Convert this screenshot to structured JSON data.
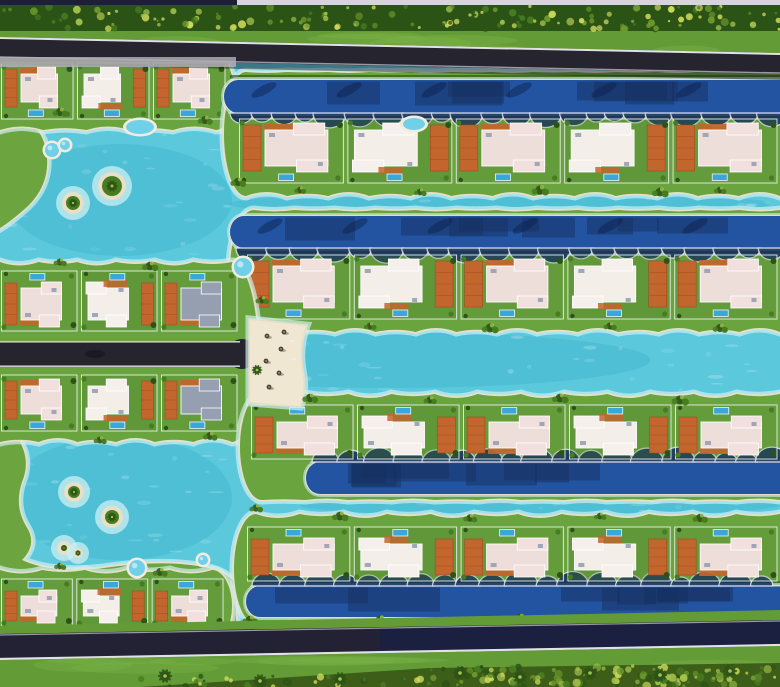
{
  "meta": {
    "description": "Aerial master-plan rendering of a crystal-lagoon villa resort community",
    "alt_text": "Top-down architectural rendering: staggered rows of white flat-roof villas with terracotta decks and private pools on green fingers of land, separated by turquoise lagoons and dark-blue canals, bounded by tree-lined roads at top and bottom"
  },
  "palette": {
    "lagoon": "#5bc8dc",
    "lagoonDeep": "#2ea8c6",
    "shallow": "#cdeff2",
    "sand": "#e9dfc6",
    "canal": "#2254a2",
    "canalShadow": "#152f60",
    "canalEdge": "#dfe2ea",
    "lawn": "#67a13e",
    "lawnDark": "#45742a",
    "hedge": "#2f5a1d",
    "road": "#26242f",
    "roadNavy": "#1c2040",
    "curb": "#e2e2e6",
    "curbSoft": "#9b97a5",
    "roofA": "#f1e0de",
    "roofB": "#f6f0ec",
    "roofGray": "#97a0b2",
    "deck": "#c2662e",
    "deckDark": "#9e4d20",
    "pool": "#39a7da",
    "poolLight": "#6fd0e8",
    "treeDark": "#2c5316",
    "treeMid": "#477d21",
    "treeLight": "#a4c24d",
    "speckle": "#cfd95c",
    "grass": "#639c36",
    "grassLight": "#7cb449",
    "topBarDark": "#1e1e36",
    "topBarLight": "#d8d5d8",
    "canopy": "#3c5e18",
    "apron": "#b7b2ba",
    "umbrella": "#4a4238"
  },
  "topBar": {
    "height": 5,
    "segments": [
      {
        "x": 0,
        "w": 237,
        "color": "topBarDark"
      },
      {
        "x": 237,
        "w": 543,
        "color": "topBarLight"
      }
    ]
  },
  "topBands": {
    "treeTop": 5,
    "treeBottom": 31,
    "grassTop": 29,
    "grassBottom": 57,
    "road": {
      "xTopL": 37,
      "xTopR": 53,
      "xBotL": 58,
      "xBotR": 74
    }
  },
  "bottomBands": {
    "verge": [
      [
        0,
        626
      ],
      [
        780,
        610
      ],
      [
        780,
        622
      ],
      [
        0,
        638
      ]
    ],
    "road": {
      "xTopL": 634,
      "xTopR": 620,
      "xBotL": 660,
      "xBotR": 646
    },
    "grass": [
      [
        0,
        660
      ],
      [
        780,
        646
      ],
      [
        780,
        687
      ],
      [
        0,
        687
      ]
    ],
    "canopy": [
      [
        140,
        687
      ],
      [
        430,
        668
      ],
      [
        780,
        663
      ],
      [
        780,
        687
      ]
    ]
  },
  "waterPatches": [
    {
      "cx": 390,
      "cy": 360,
      "rx": 260,
      "ry": 28
    },
    {
      "cx": 120,
      "cy": 200,
      "rx": 112,
      "ry": 56
    },
    {
      "cx": 120,
      "cy": 498,
      "rx": 112,
      "ry": 62
    },
    {
      "cx": 500,
      "cy": 204,
      "rx": 270,
      "ry": 12
    },
    {
      "cx": 540,
      "cy": 505,
      "rx": 240,
      "ry": 11
    }
  ],
  "sparkleRegions": [
    {
      "x": 10,
      "y": 132,
      "w": 220,
      "h": 128
    },
    {
      "x": 250,
      "y": 332,
      "w": 520,
      "h": 58
    },
    {
      "x": 8,
      "y": 442,
      "w": 220,
      "h": 112
    },
    {
      "x": 250,
      "y": 197,
      "w": 520,
      "h": 16
    },
    {
      "x": 320,
      "y": 497,
      "w": 450,
      "h": 18
    }
  ],
  "shores": [
    {
      "name": "upper-left-shore",
      "d": "M0,108 Q40,118 46,150 Q52,182 28,206 Q10,222 0,228 Z"
    },
    {
      "name": "lower-left-shore",
      "d": "M0,432 L16,436 Q32,458 22,482 Q14,506 26,526 Q38,544 22,560 Q52,574 104,568 Q158,560 198,566 Q226,570 236,584 L236,640 L0,640 Z"
    }
  ],
  "lands": [
    {
      "name": "villa-block-a",
      "x0": 0,
      "x1": 234,
      "yt": 56,
      "yb": 130,
      "ampT": 0,
      "ampB": 7,
      "capL": 0,
      "capR": 18,
      "rows": [
        {
          "x": 0,
          "x1": 228,
          "y": 60,
          "h": 62,
          "units": 3,
          "poolSide": "bottom",
          "style": "left"
        }
      ]
    },
    {
      "name": "lagoon-finger-1",
      "x0": 224,
      "x1": 780,
      "yt": 72,
      "yb": 196,
      "ampT": 2,
      "ampB": 8,
      "capL": 22,
      "capR": 0,
      "canal": {
        "x": 224,
        "y": 80,
        "h": 33,
        "cap": 14,
        "scallop": "bottom",
        "palms": true
      },
      "rows": [
        {
          "x": 238,
          "x1": 780,
          "y": 116,
          "h": 70,
          "units": 5,
          "poolSide": "bottom"
        }
      ],
      "hedgeY": 75
    },
    {
      "name": "lagoon-finger-2",
      "x0": 230,
      "x1": 780,
      "yt": 210,
      "yb": 332,
      "ampT": 3,
      "ampB": 8,
      "capL": 24,
      "capR": 0,
      "canal": {
        "x": 230,
        "y": 216,
        "h": 32,
        "cap": 14,
        "scallop": "bottom",
        "palms": true
      },
      "rows": [
        {
          "x": 246,
          "x1": 780,
          "y": 252,
          "h": 70,
          "units": 5,
          "poolSide": "bottom"
        }
      ]
    },
    {
      "name": "villa-block-b-c",
      "x0": 0,
      "x1": 258,
      "yt": 262,
      "yb": 442,
      "ampT": 7,
      "ampB": 8,
      "capL": 0,
      "capR": 26,
      "rows": [
        {
          "x": 0,
          "x1": 240,
          "y": 268,
          "h": 66,
          "units": 3,
          "poolSide": "top",
          "style": "left",
          "darkEnd": true
        },
        {
          "x": 0,
          "x1": 240,
          "y": 372,
          "h": 62,
          "units": 3,
          "poolSide": "bottom",
          "style": "left",
          "darkEnd": true
        }
      ],
      "midRoad": {
        "y": 341,
        "h": 26,
        "x1": 240
      }
    },
    {
      "name": "lagoon-finger-3",
      "x0": 240,
      "x1": 780,
      "yt": 394,
      "yb": 500,
      "ampT": 8,
      "ampB": 3,
      "capL": 22,
      "capR": 0,
      "canal": {
        "x": 306,
        "y": 462,
        "h": 32,
        "cap": 14,
        "scallop": "top"
      },
      "rows": [
        {
          "x": 250,
          "x1": 780,
          "y": 402,
          "h": 60,
          "units": 5,
          "poolSide": "top"
        }
      ]
    },
    {
      "name": "lagoon-finger-4",
      "x0": 234,
      "x1": 780,
      "yt": 514,
      "yb": 624,
      "ampT": 8,
      "ampB": 0,
      "capL": 22,
      "capR": 0,
      "canal": {
        "x": 246,
        "y": 586,
        "h": 31,
        "cap": 14,
        "scallop": "top"
      },
      "rows": [
        {
          "x": 246,
          "x1": 780,
          "y": 524,
          "h": 60,
          "units": 5,
          "poolSide": "top"
        }
      ]
    },
    {
      "name": "villa-block-d",
      "x0": 0,
      "x1": 232,
      "yt": 570,
      "yb": 642,
      "ampT": 7,
      "ampB": 0,
      "capL": 0,
      "capR": 20,
      "rows": [
        {
          "x": 0,
          "x1": 226,
          "y": 576,
          "h": 54,
          "units": 3,
          "poolSide": "top",
          "style": "left"
        }
      ]
    }
  ],
  "beach": {
    "d": "M250,320 L306,326 Q298,348 302,370 Q306,390 300,406 L250,402 Z",
    "umbrellas": [
      [
        267,
        336
      ],
      [
        281,
        349
      ],
      [
        266,
        361
      ],
      [
        279,
        373
      ],
      [
        269,
        387
      ],
      [
        284,
        332
      ]
    ],
    "loungers": [
      [
        290,
        340
      ],
      [
        292,
        358
      ]
    ]
  },
  "islands": [
    {
      "cx": 112,
      "cy": 186,
      "r": 14
    },
    {
      "cx": 73,
      "cy": 203,
      "r": 11
    },
    {
      "cx": 74,
      "cy": 492,
      "r": 10
    },
    {
      "cx": 112,
      "cy": 517,
      "r": 11
    },
    {
      "cx": 64,
      "cy": 548,
      "r": 7
    },
    {
      "cx": 78,
      "cy": 553,
      "r": 5
    }
  ],
  "featurePools": [
    {
      "cx": 52,
      "cy": 150,
      "r": 7
    },
    {
      "cx": 65,
      "cy": 145,
      "r": 5
    },
    {
      "cx": 243,
      "cy": 267,
      "r": 9
    },
    {
      "cx": 137,
      "cy": 568,
      "r": 8
    },
    {
      "cx": 203,
      "cy": 560,
      "r": 5
    }
  ],
  "ellipsePools": [
    {
      "cx": 140,
      "cy": 127,
      "rx": 14,
      "ry": 7
    },
    {
      "cx": 414,
      "cy": 124,
      "rx": 11,
      "ry": 6
    }
  ],
  "clusters": [
    [
      205,
      120
    ],
    [
      60,
      112
    ],
    [
      238,
      182
    ],
    [
      300,
      190
    ],
    [
      420,
      192
    ],
    [
      540,
      190
    ],
    [
      660,
      192
    ],
    [
      720,
      190
    ],
    [
      262,
      300
    ],
    [
      370,
      326
    ],
    [
      490,
      328
    ],
    [
      610,
      326
    ],
    [
      720,
      328
    ],
    [
      150,
      266
    ],
    [
      60,
      262
    ],
    [
      210,
      436
    ],
    [
      100,
      440
    ],
    [
      310,
      398
    ],
    [
      430,
      400
    ],
    [
      560,
      398
    ],
    [
      680,
      400
    ],
    [
      256,
      508
    ],
    [
      340,
      516
    ],
    [
      470,
      518
    ],
    [
      600,
      516
    ],
    [
      700,
      518
    ],
    [
      160,
      572
    ],
    [
      60,
      566
    ],
    [
      250,
      620
    ],
    [
      380,
      620
    ],
    [
      520,
      618
    ],
    [
      660,
      618
    ]
  ],
  "bottomPalms": [
    [
      165,
      676
    ],
    [
      260,
      681
    ],
    [
      340,
      679
    ],
    [
      460,
      673
    ],
    [
      520,
      677
    ],
    [
      590,
      673
    ],
    [
      660,
      675
    ],
    [
      730,
      671
    ]
  ],
  "topPalms": [
    [
      163,
      19
    ],
    [
      470,
      15
    ],
    [
      700,
      17
    ]
  ]
}
